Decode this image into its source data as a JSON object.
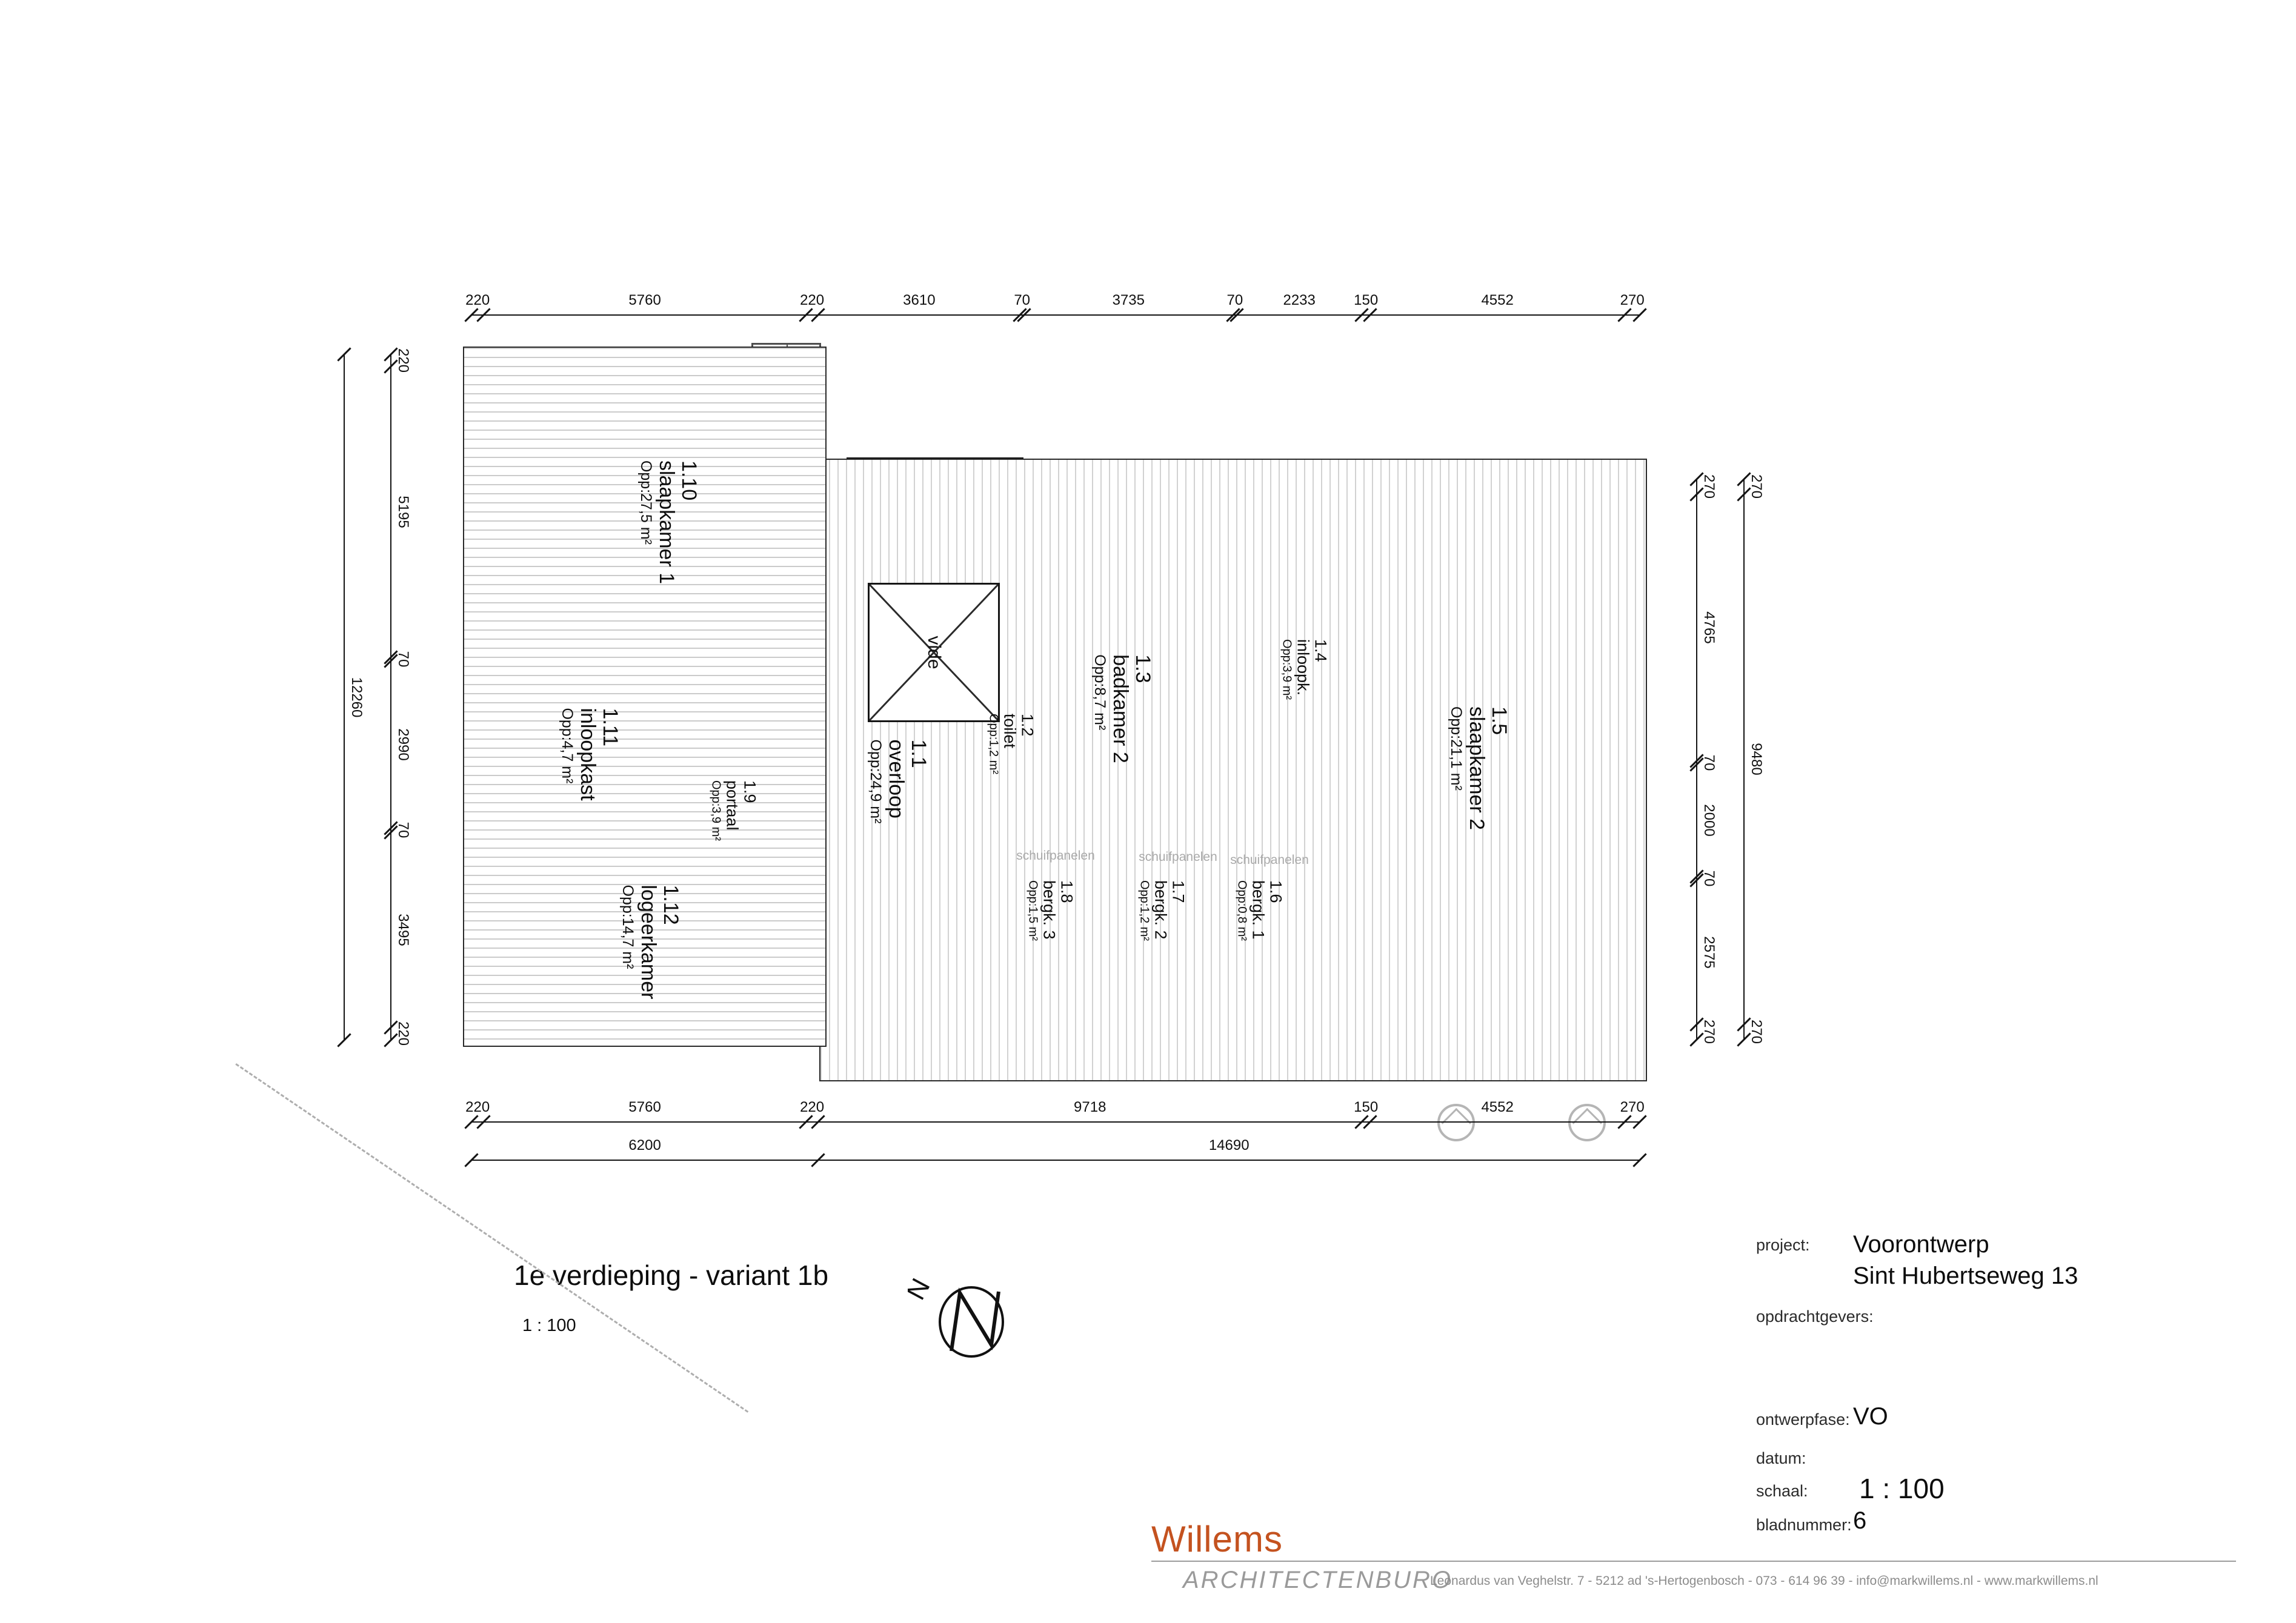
{
  "sheet": {
    "title": "1e verdieping - variant 1b",
    "scale": "1 : 100",
    "north_label": "N"
  },
  "rooms": {
    "r11": {
      "number": "1.1",
      "name": "overloop",
      "area": "Opp:24,9 m²"
    },
    "r12": {
      "number": "1.2",
      "name": "toilet",
      "area": "Opp:1,2 m²"
    },
    "r13": {
      "number": "1.3",
      "name": "badkamer 2",
      "area": "Opp:8,7 m²"
    },
    "r14": {
      "number": "1.4",
      "name": "inloopk.",
      "area": "Opp:3,9 m²"
    },
    "r15": {
      "number": "1.5",
      "name": "slaapkamer 2",
      "area": "Opp:21,1 m²"
    },
    "r16": {
      "number": "1.6",
      "name": "bergk. 1",
      "area": "Opp:0,8 m²"
    },
    "r17": {
      "number": "1.7",
      "name": "bergk. 2",
      "area": "Opp:1,2 m²"
    },
    "r18": {
      "number": "1.8",
      "name": "bergk. 3",
      "area": "Opp:1,5 m²"
    },
    "r19": {
      "number": "1.9",
      "name": "portaal",
      "area": "Opp:3,9 m²"
    },
    "r110": {
      "number": "1.10",
      "name": "slaapkamer 1",
      "area": "Opp:27,5 m²"
    },
    "r111": {
      "number": "1.11",
      "name": "inloopkast",
      "area": "Opp:4,7 m²"
    },
    "r112": {
      "number": "1.12",
      "name": "logeerkamer",
      "area": "Opp:14,7 m²"
    },
    "vide": "vide",
    "schuifpanelen": "schuifpanelen"
  },
  "dimensions": {
    "top": [
      "220",
      "5760",
      "220",
      "3610",
      "70",
      "3735",
      "70",
      "2233",
      "150",
      "4552",
      "270"
    ],
    "bottom_row1": [
      "220",
      "5760",
      "220",
      "9718",
      "150",
      "4552",
      "270"
    ],
    "bottom_row2": [
      "6200",
      "14690"
    ],
    "left_inner": [
      "220",
      "5195",
      "70",
      "2990",
      "70",
      "3495",
      "220"
    ],
    "left_outer": [
      "12260"
    ],
    "right_inner": [
      "270",
      "4765",
      "70",
      "2000",
      "70",
      "2575",
      "270"
    ],
    "right_outer": [
      "270",
      "9480",
      "270"
    ]
  },
  "titleblock": {
    "project_label": "project:",
    "project_value_line1": "Voorontwerp",
    "project_value_line2": "Sint Hubertseweg 13",
    "clients_label": "opdrachtgevers:",
    "phase_label": "ontwerpfase:",
    "phase_value": "VO",
    "date_label": "datum:",
    "scale_label": "schaal:",
    "scale_value": "1 : 100",
    "sheet_label": "bladnummer:",
    "sheet_value": "6"
  },
  "footer": {
    "logo_name": "Willems",
    "logo_sub": "ARCHITECTENBURO",
    "address": "Leonardus van Veghelstr. 7  -  5212 ad 's-Hertogenbosch  -  073  -  614 96 39  -  info@markwillems.nl  -  www.markwillems.nl",
    "logo_color": "#c4521f"
  }
}
